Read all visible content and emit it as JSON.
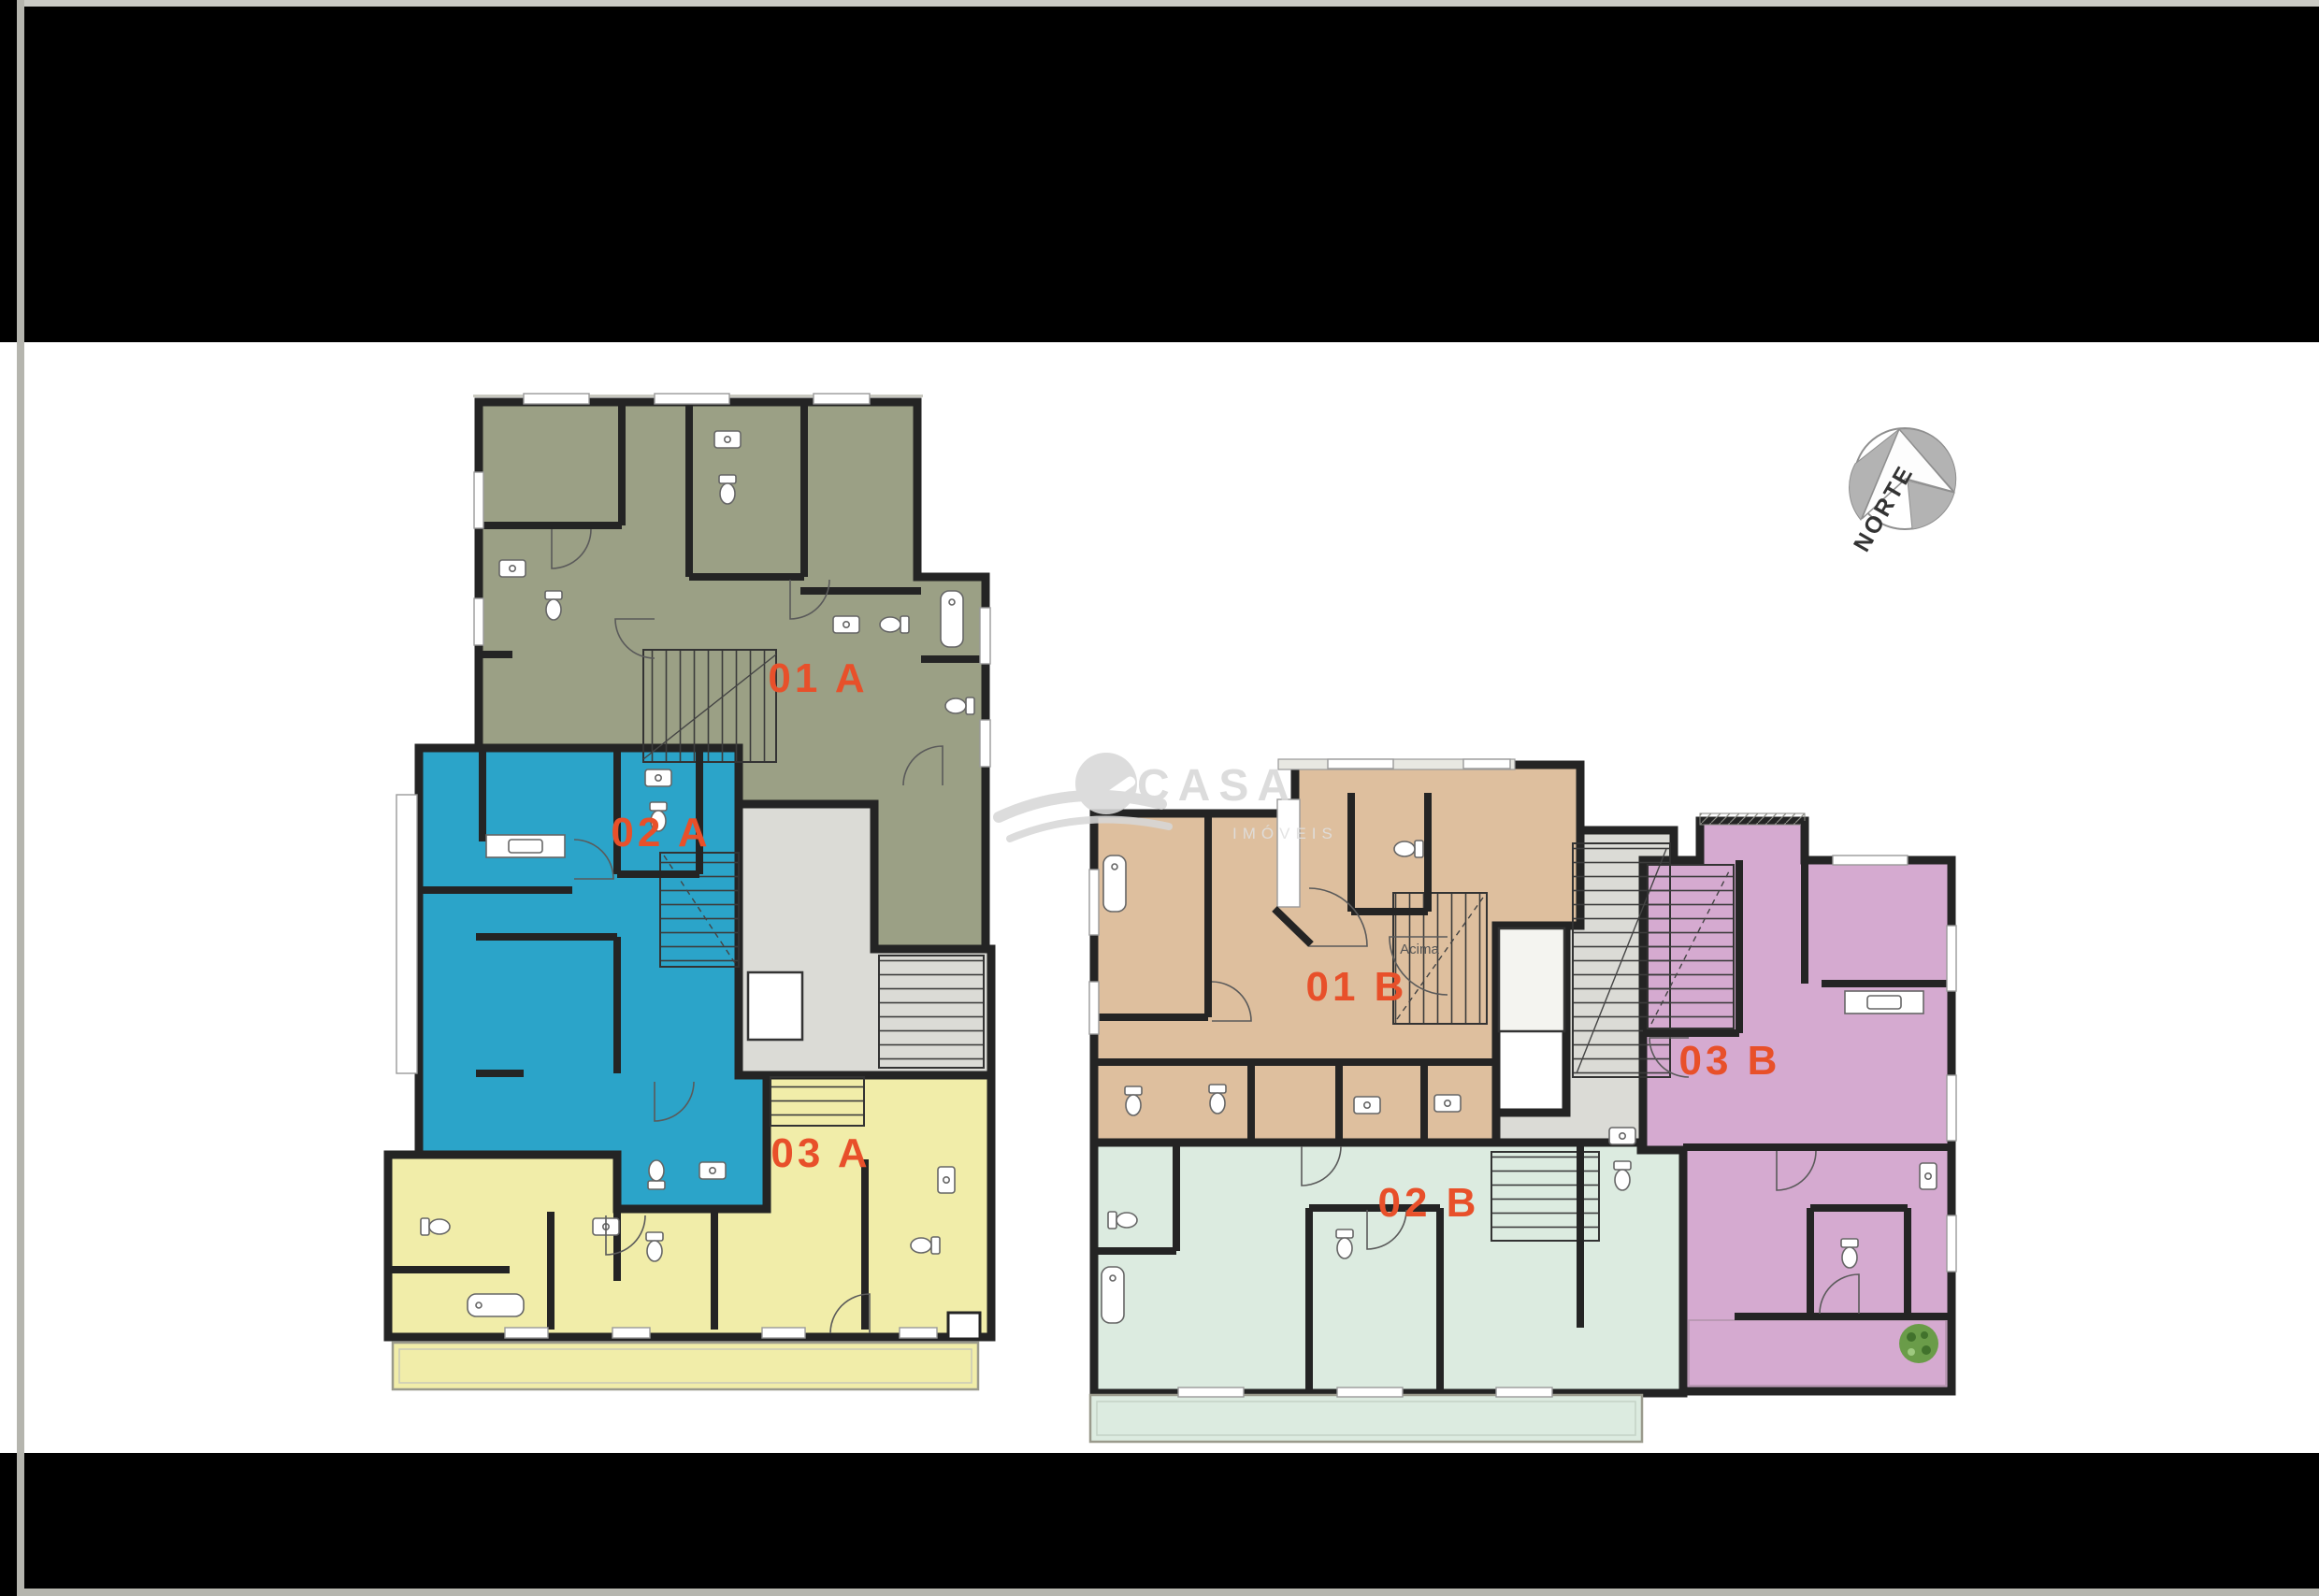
{
  "document": {
    "type": "residential-floor-plan-sheet"
  },
  "compass": {
    "label": "NORTE"
  },
  "watermark": {
    "brand": "CASA",
    "tagline": "IMÓVEIS",
    "color": "#d8d8d8"
  },
  "floor_plans": [
    {
      "tower": "A",
      "units": [
        {
          "code": "01 A",
          "color": "#9ba085"
        },
        {
          "code": "02 A",
          "color": "#2ba4c9"
        },
        {
          "code": "03 A",
          "color": "#f1eda9"
        }
      ]
    },
    {
      "tower": "B",
      "stair_note": "Acima",
      "units": [
        {
          "code": "01 B",
          "color": "#debf9e"
        },
        {
          "code": "02 B",
          "color": "#dcebe0"
        },
        {
          "code": "03 B",
          "color": "#d5aad0"
        }
      ]
    }
  ],
  "colors": {
    "band": "#000000",
    "page_edge": "#b5b5ae",
    "top_hairline": "#cacac4",
    "core": "#dbdbd6",
    "unit_label": "#e8502a",
    "compass_fill": "#b3b3b3",
    "compass_text": "#333333",
    "tree_foliage": "#6a9c49",
    "tree_shadow": "#41722c"
  }
}
